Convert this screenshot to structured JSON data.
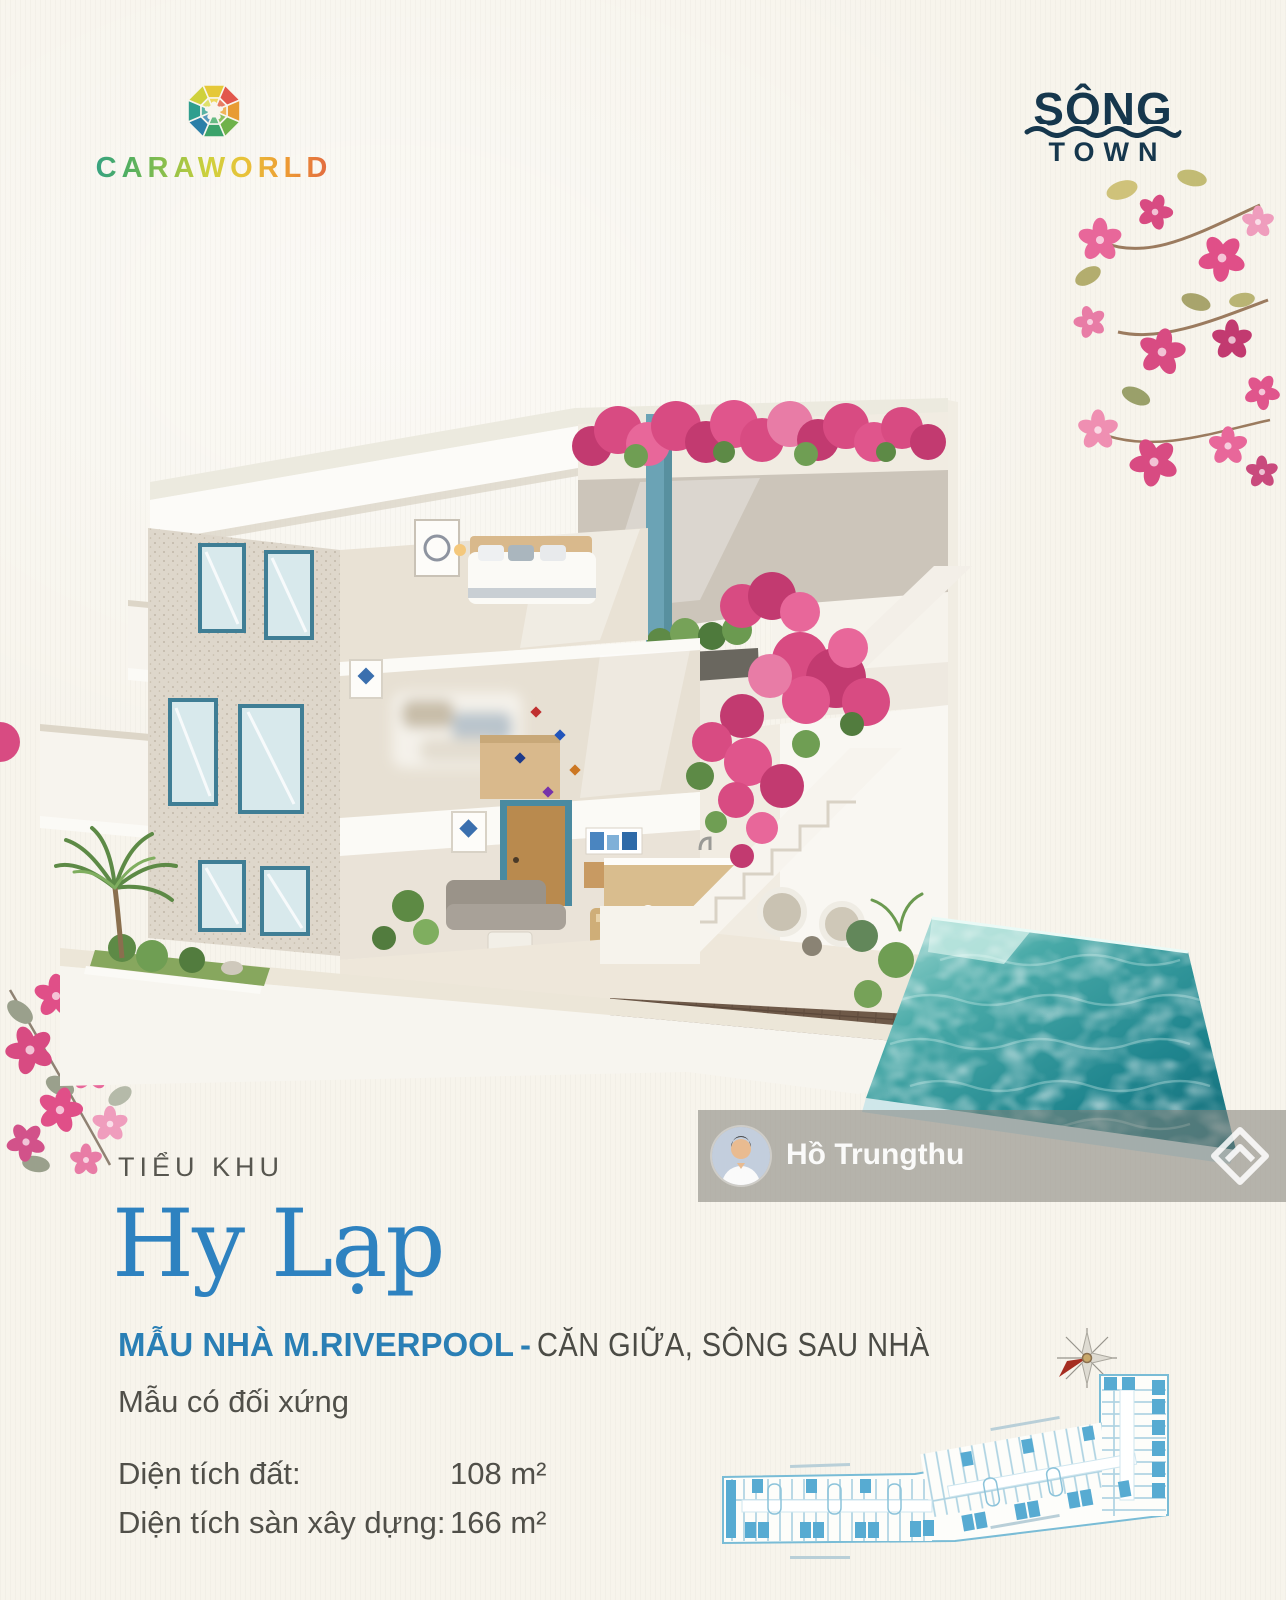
{
  "page": {
    "background": "#f7f4ec"
  },
  "branding": {
    "caraworld": {
      "name": "CARAWORLD"
    },
    "song_town": {
      "top": "SÔNG",
      "bottom": "TOWN"
    }
  },
  "watermark": {
    "agent_name": "Hồ Trungthu"
  },
  "listing": {
    "eyebrow": "TIỂU KHU",
    "title": "Hy Lạp",
    "model_name": "MẪU NHÀ M.RIVERPOOL",
    "separator": "-",
    "position_note": "CĂN GIỮA, SÔNG SAU NHÀ",
    "symmetry_note": "Mẫu có đối xứng",
    "areas": [
      {
        "label": "Diện tích đất:",
        "value": "108 m²"
      },
      {
        "label": "Diện tích sàn xây dựng:",
        "value": "166 m²"
      }
    ]
  },
  "icons": {
    "emblem": "caraworld-mosaic-emblem",
    "compass": "compass-rose-icon",
    "site_logo": "diamond-chevron-logo",
    "avatar": "agent-photo-avatar"
  },
  "colors": {
    "title_blue": "#2e82c0",
    "model_blue": "#2a7fb5",
    "text_gray": "#504f49",
    "brand_navy": "#16374d",
    "pool_teal": "#1f858e",
    "bougainvillea_pink": "#d84b82",
    "plan_blue": "#57abd2"
  }
}
